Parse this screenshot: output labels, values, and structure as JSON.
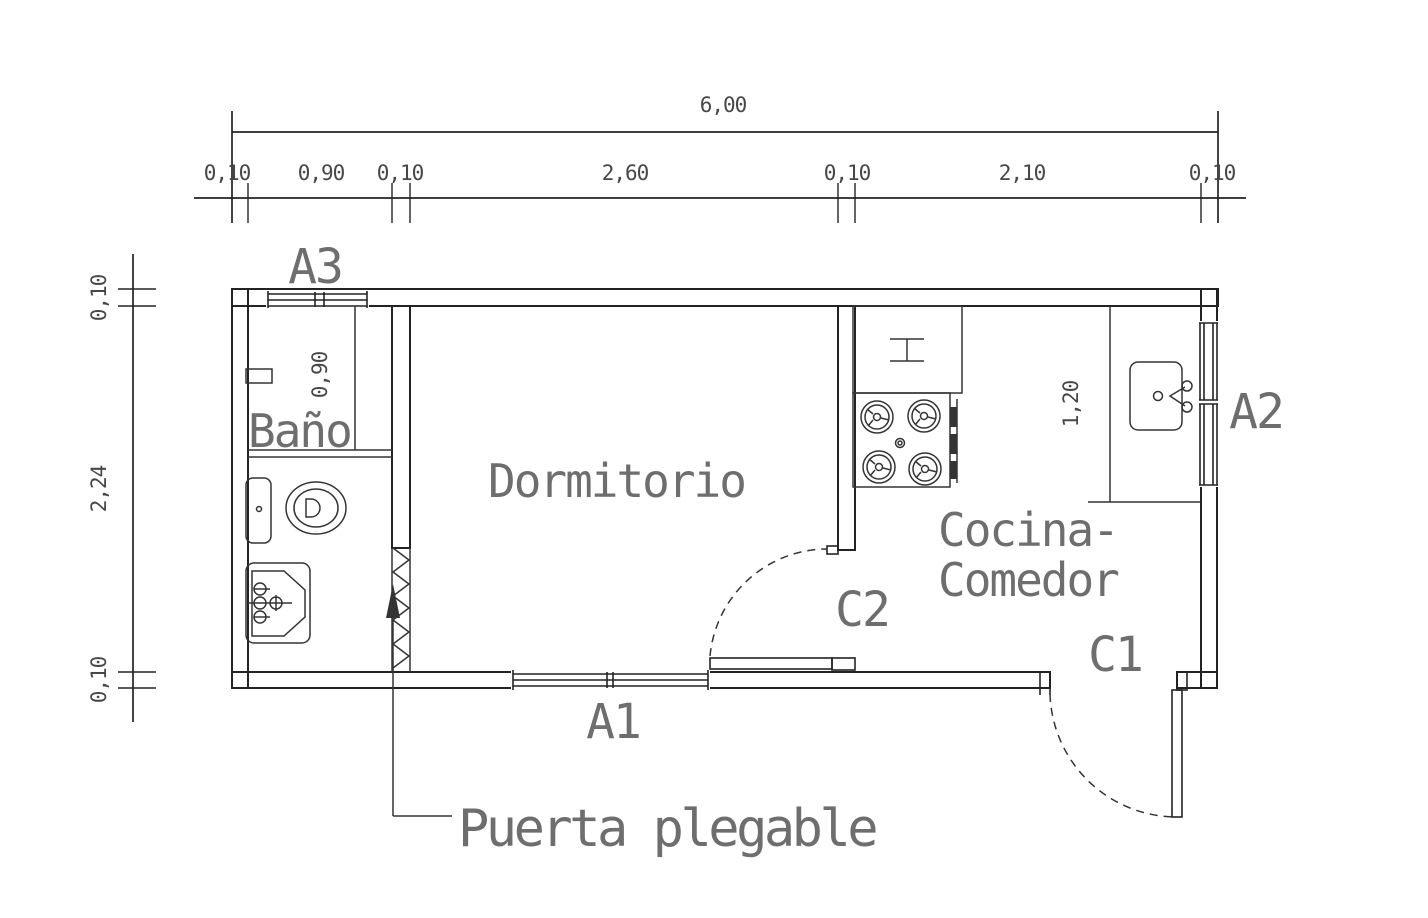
{
  "labels": {
    "rooms": {
      "bathroom": "Baño",
      "bedroom": "Dormitorio",
      "kitchen_line1": "Cocina-",
      "kitchen_line2": "Comedor"
    },
    "openings": {
      "a1": "A1",
      "a2": "A2",
      "a3": "A3",
      "c1": "C1",
      "c2": "C2"
    },
    "note_folding_door": "Puerta plegable"
  },
  "dimensions": {
    "total_width": "6,00",
    "top_row": [
      "0,10",
      "0,90",
      "0,10",
      "2,60",
      "0,10",
      "2,10",
      "0,10"
    ],
    "left_column": [
      "0,10",
      "2,24",
      "0,10"
    ],
    "bathroom_inner_depth": "0,90",
    "kitchen_counter_depth": "1,20"
  },
  "fixtures": [
    "toilet",
    "bathroom-sink",
    "shower-niche",
    "folding-door",
    "stove-4-burner",
    "counter-symbol",
    "kitchen-sink"
  ],
  "colors": {
    "line": "#232323",
    "fixture": "#343434",
    "text_dim": "#474747",
    "text_label": "#6e6e6e",
    "background": "#ffffff"
  }
}
